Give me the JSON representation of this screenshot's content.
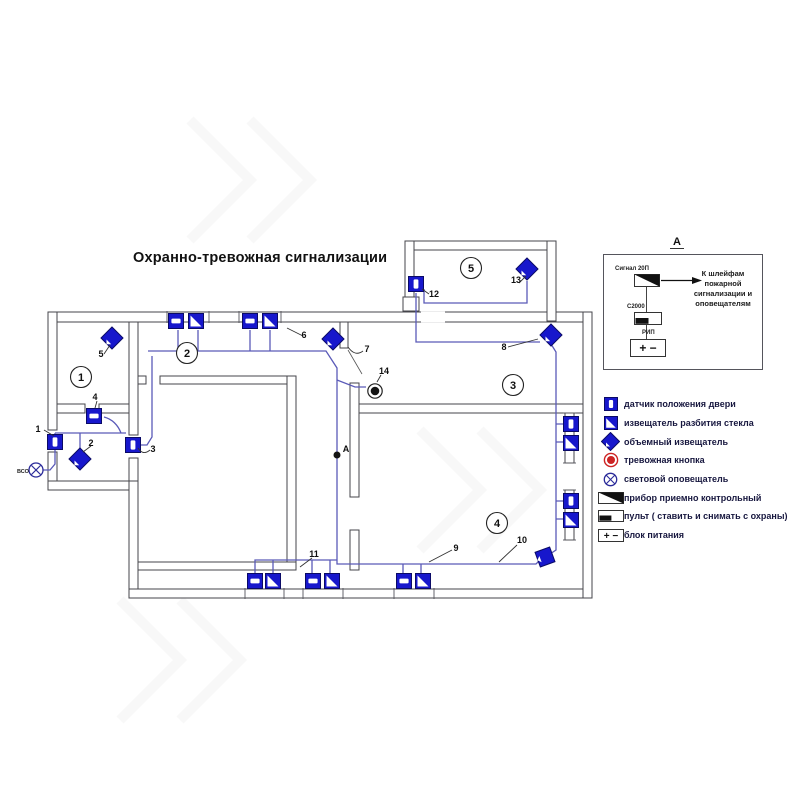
{
  "title": "Охранно-тревожная сигнализации",
  "plan": {
    "room_numbers": [
      "1",
      "2",
      "3",
      "4",
      "5"
    ],
    "item_labels": [
      "1",
      "2",
      "3",
      "4",
      "5",
      "6",
      "7",
      "8",
      "9",
      "10",
      "11",
      "12",
      "13",
      "14"
    ],
    "point_a_label": "А",
    "annunciator_label": "ВСО"
  },
  "detail_a": {
    "header": "А",
    "ppk_label": "Сигнал 20П",
    "console_label": "С2000",
    "psu_label": "РИП",
    "note": "К шлейфам пожарной сигнализации и оповещателям"
  },
  "symbols": {
    "psu_terminals": "+ −"
  },
  "legend": {
    "items": [
      {
        "icon": "door-position-sensor-icon",
        "label": "датчик положения двери"
      },
      {
        "icon": "glass-break-detector-icon",
        "label": "извещатель разбития стекла"
      },
      {
        "icon": "volumetric-detector-icon",
        "label": "объемный извещатель"
      },
      {
        "icon": "panic-button-icon",
        "label": "тревожная кнопка"
      },
      {
        "icon": "light-annunciator-icon",
        "label": "световой оповещатель"
      },
      {
        "icon": "control-panel-icon",
        "label": "прибор приемно контрольный"
      },
      {
        "icon": "console-icon",
        "label": "пульт ( ставить и снимать с охраны)"
      },
      {
        "icon": "power-supply-icon",
        "label": "блок питания"
      }
    ]
  },
  "colors": {
    "detector_blue": "#1717cc",
    "wire_blue": "#5a5ab8",
    "alarm_red": "#cc2222",
    "wall_gray": "#45454b"
  }
}
